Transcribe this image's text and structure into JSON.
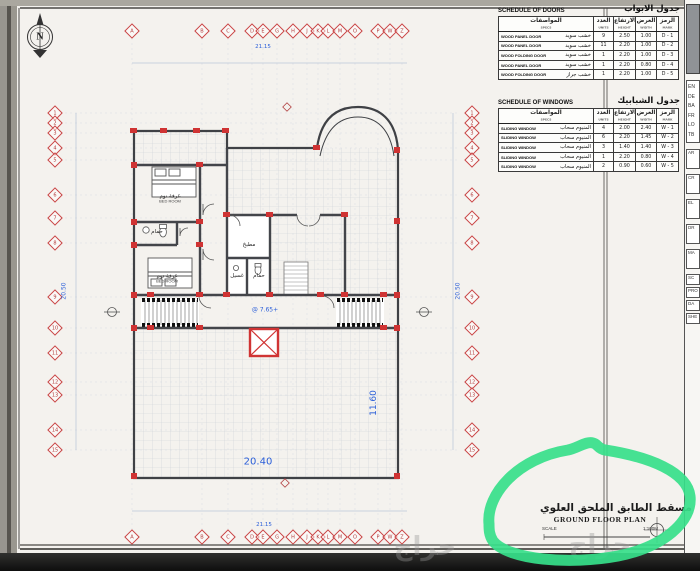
{
  "sheet": {
    "compass_label": "N",
    "watermark": "حراج"
  },
  "doors_schedule": {
    "title_en": "SCHEDULE OF DOORS",
    "title_ar": "جدول الابواب",
    "headers": [
      {
        "ar": "المواصفات",
        "en": "SPECS"
      },
      {
        "ar": "العدد",
        "en": "UNITS"
      },
      {
        "ar": "الارتفاع",
        "en": "HEIGHT"
      },
      {
        "ar": "العرض",
        "en": "WIDTH"
      },
      {
        "ar": "الرمز",
        "en": "MARK"
      }
    ],
    "rows": [
      {
        "spec_en": "WOOD PANEL DOOR",
        "spec_ar": "خشب سويد",
        "qty": "9",
        "height": "2.50",
        "width": "1.00",
        "mark": "D - 1"
      },
      {
        "spec_en": "WOOD PANEL DOOR",
        "spec_ar": "خشب سويد",
        "qty": "11",
        "height": "2.20",
        "width": "1.00",
        "mark": "D - 2"
      },
      {
        "spec_en": "WOOD FOLDING DOOR",
        "spec_ar": "خشب سويد",
        "qty": "1",
        "height": "2.20",
        "width": "1.00",
        "mark": "D - 3"
      },
      {
        "spec_en": "WOOD PANEL DOOR",
        "spec_ar": "خشب سويد",
        "qty": "1",
        "height": "2.20",
        "width": "0.80",
        "mark": "D - 4"
      },
      {
        "spec_en": "WOOD FOLDING DOOR",
        "spec_ar": "خشب جراز",
        "qty": "1",
        "height": "2.20",
        "width": "1.00",
        "mark": "D - 5"
      }
    ]
  },
  "windows_schedule": {
    "title_en": "SCHEDULE OF WINDOWS",
    "title_ar": "جدول الشبابيك",
    "headers": [
      {
        "ar": "المواصفات",
        "en": "SPECS"
      },
      {
        "ar": "العدد",
        "en": "UNITS"
      },
      {
        "ar": "الارتفاع",
        "en": "HEIGHT"
      },
      {
        "ar": "العرض",
        "en": "WIDTH"
      },
      {
        "ar": "الرمز",
        "en": "MARK"
      }
    ],
    "rows": [
      {
        "spec_en": "SLIDING WINDOW",
        "spec_ar": "المنيوم سحاب",
        "qty": "4",
        "height": "2.00",
        "width": "2.40",
        "mark": "W - 1"
      },
      {
        "spec_en": "SLIDING WINDOW",
        "spec_ar": "المنيوم سحاب",
        "qty": "6",
        "height": "2.20",
        "width": "1.45",
        "mark": "W - 2"
      },
      {
        "spec_en": "SLIDING WINDOW",
        "spec_ar": "المنيوم سحاب",
        "qty": "3",
        "height": "1.40",
        "width": "1.40",
        "mark": "W - 3"
      },
      {
        "spec_en": "SLIDING WINDOW",
        "spec_ar": "المنيوم سحاب",
        "qty": "1",
        "height": "2.20",
        "width": "0.80",
        "mark": "W - 4"
      },
      {
        "spec_en": "SLIDING WINDOW",
        "spec_ar": "المنيوم سحاب",
        "qty": "2",
        "height": "0.90",
        "width": "0.60",
        "mark": "W - 5"
      }
    ]
  },
  "title_block": {
    "title_ar": "مسقط الطابق الملحق العلوي",
    "title_en": "GROUND FLOOR PLAN",
    "scale_label": "SCALE",
    "scale_value": "1:100M"
  },
  "plan": {
    "level_label": "@ 7.65+",
    "totals": {
      "top": "21.15",
      "bottom": "21.15",
      "left": "20.50",
      "right": "20.50",
      "terrace_w": "20.40",
      "terrace_h": "11.60"
    },
    "axis_letters": [
      {
        "l": "A",
        "x": 132
      },
      {
        "l": "B",
        "x": 202
      },
      {
        "l": "C",
        "x": 228
      },
      {
        "l": "D",
        "x": 252
      },
      {
        "l": "E",
        "x": 263
      },
      {
        "l": "G",
        "x": 277
      },
      {
        "l": "H",
        "x": 293
      },
      {
        "l": "J",
        "x": 307
      },
      {
        "l": "K",
        "x": 318
      },
      {
        "l": "L",
        "x": 328
      },
      {
        "l": "M",
        "x": 340
      },
      {
        "l": "O",
        "x": 355
      },
      {
        "l": "P",
        "x": 378
      },
      {
        "l": "W",
        "x": 390
      },
      {
        "l": "Z",
        "x": 402
      }
    ],
    "axis_numbers": [
      {
        "l": "1",
        "y": 113
      },
      {
        "l": "2",
        "y": 123
      },
      {
        "l": "3",
        "y": 133
      },
      {
        "l": "4",
        "y": 148
      },
      {
        "l": "5",
        "y": 160
      },
      {
        "l": "6",
        "y": 195
      },
      {
        "l": "7",
        "y": 218
      },
      {
        "l": "8",
        "y": 243
      },
      {
        "l": "9",
        "y": 297
      },
      {
        "l": "10",
        "y": 328
      },
      {
        "l": "11",
        "y": 353
      },
      {
        "l": "12",
        "y": 382
      },
      {
        "l": "13",
        "y": 395
      },
      {
        "l": "14",
        "y": 430
      },
      {
        "l": "15",
        "y": 450
      }
    ],
    "dims_h": [
      {
        "v": "5.40",
        "x": 166
      },
      {
        "v": "2.15",
        "x": 215
      },
      {
        "v": "1.90",
        "x": 241
      },
      {
        "v": "1.20",
        "x": 258
      },
      {
        "v": "1.20",
        "x": 271
      },
      {
        "v": "1.20",
        "x": 284
      },
      {
        "v": "1.60",
        "x": 299
      },
      {
        "v": "0.90",
        "x": 318
      },
      {
        "v": "0.27",
        "x": 331
      },
      {
        "v": "2.10",
        "x": 348
      },
      {
        "v": "1.20",
        "x": 372
      },
      {
        "v": "0.52",
        "x": 381
      },
      {
        "v": "1.20",
        "x": 390
      },
      {
        "v": "0.55",
        "x": 402
      }
    ],
    "dims_v": [
      {
        "v": "1.00",
        "y": 118
      },
      {
        "v": "0.90",
        "y": 128
      },
      {
        "v": "1.50",
        "y": 141
      },
      {
        "v": "1.20",
        "y": 154
      },
      {
        "v": "3.50",
        "y": 177
      },
      {
        "v": "2.30",
        "y": 206
      },
      {
        "v": "2.50",
        "y": 231
      },
      {
        "v": "5.40",
        "y": 270
      },
      {
        "v": "3.10",
        "y": 312
      },
      {
        "v": "2.50",
        "y": 340
      },
      {
        "v": "2.90",
        "y": 367
      },
      {
        "v": "1.30",
        "y": 389
      },
      {
        "v": "3.50",
        "y": 412
      },
      {
        "v": "2.00",
        "y": 440
      }
    ],
    "blue_h": [
      {
        "v": "7.00",
        "x": 172,
        "y": 141
      },
      {
        "v": "3.00",
        "x": 213,
        "y": 289
      },
      {
        "v": "1.60",
        "x": 240,
        "y": 289
      },
      {
        "v": "1.20",
        "x": 261,
        "y": 289
      },
      {
        "v": "5.98",
        "x": 252,
        "y": 252
      },
      {
        "v": "1.50",
        "x": 377,
        "y": 312
      },
      {
        "v": "1.80",
        "x": 148,
        "y": 303
      },
      {
        "v": "1.40",
        "x": 264,
        "y": 345
      }
    ],
    "blue_v": [
      {
        "v": "3.55",
        "x": 150,
        "y": 186
      },
      {
        "v": "3.55",
        "x": 148,
        "y": 267
      },
      {
        "v": "1.20",
        "x": 204,
        "y": 190
      },
      {
        "v": "2.20",
        "x": 232,
        "y": 250
      }
    ],
    "room_labels": [
      {
        "ar": "غرفة نوم",
        "en": "BED ROOM",
        "x": 170,
        "y": 199
      },
      {
        "ar": "غرفة نوم",
        "en": "BED ROOM",
        "x": 167,
        "y": 279
      },
      {
        "ar": "حمام",
        "en": "",
        "x": 157,
        "y": 232
      },
      {
        "ar": "مطبخ",
        "en": "",
        "x": 249,
        "y": 245
      },
      {
        "ar": "غسيل",
        "en": "",
        "x": 237,
        "y": 276
      },
      {
        "ar": "حمام",
        "en": "",
        "x": 259,
        "y": 276
      }
    ]
  },
  "right_strip": {
    "top_labels": [
      "EN",
      "DE",
      "BA",
      "FR",
      "LO",
      "TB"
    ],
    "mid_labels": [
      "AR",
      "CR",
      "EL",
      "DR",
      "MA"
    ],
    "bottom_labels": [
      "SC",
      "PRO",
      "DA",
      "SHE"
    ]
  },
  "colors": {
    "marker_green": "#36e08a",
    "axis_red": "#c94444",
    "dim_blue": "#2b5fd9"
  }
}
